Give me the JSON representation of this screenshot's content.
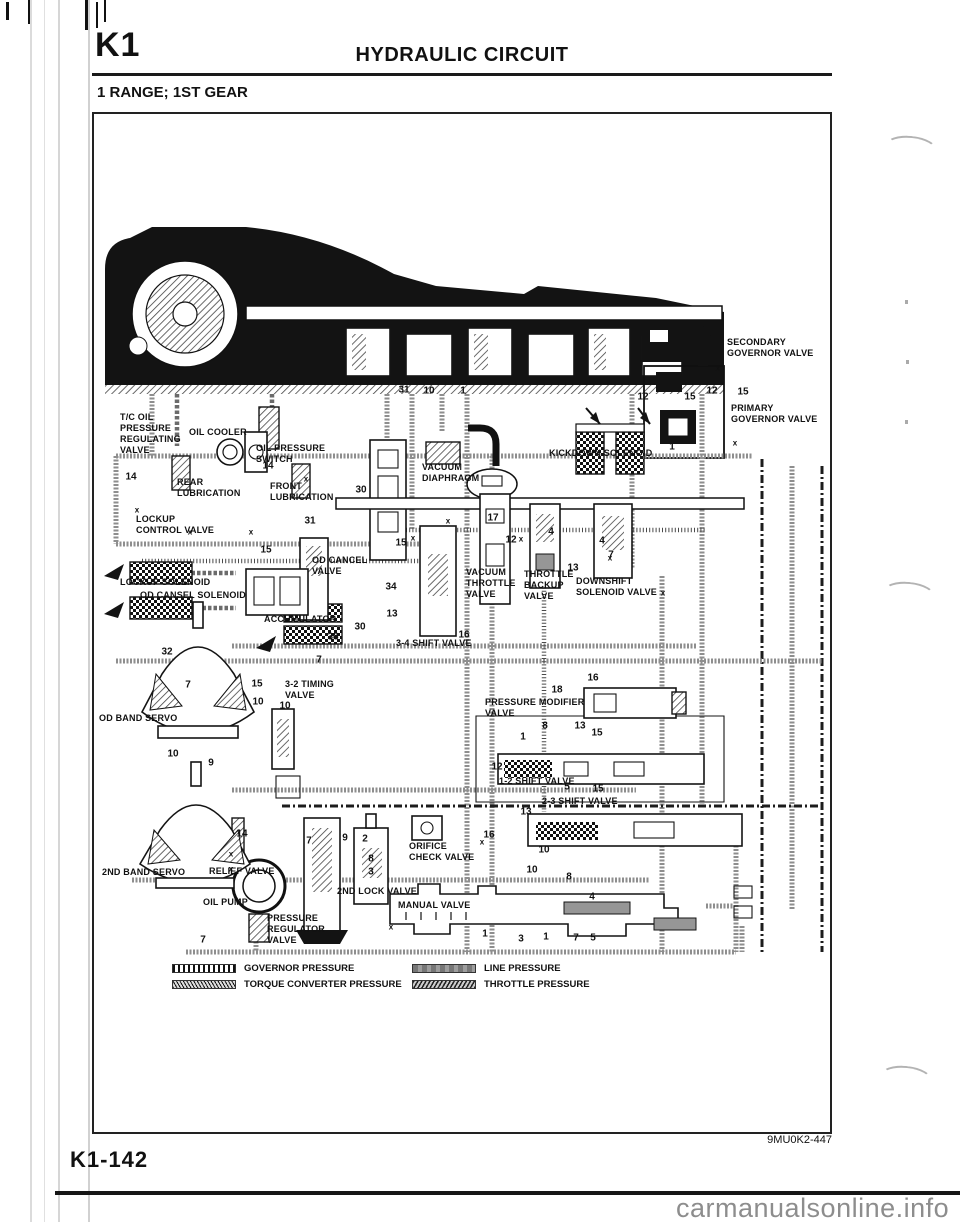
{
  "header": {
    "section_code": "K1",
    "title": "HYDRAULIC CIRCUIT"
  },
  "subtitle": "1 RANGE; 1ST GEAR",
  "diagram": {
    "figure_code": "9MU0K2-447",
    "labels": [
      {
        "name": "tc-oil-pressure-regulating-valve",
        "text": "T/C OIL\nPRESSURE\nREGULATING\nVALVE",
        "x": 120,
        "y": 412
      },
      {
        "name": "oil-cooler",
        "text": "OIL COOLER",
        "x": 189,
        "y": 427
      },
      {
        "name": "oil-pressure-switch",
        "text": "OIL PRESSURE\nSWITCH",
        "x": 256,
        "y": 443
      },
      {
        "name": "rear-lubrication",
        "text": "REAR\nLUBRICATION",
        "x": 177,
        "y": 477
      },
      {
        "name": "front-lubrication",
        "text": "FRONT\nLUBRICATION",
        "x": 270,
        "y": 481
      },
      {
        "name": "lockup-control-valve",
        "text": "LOCKUP\nCONTROL VALVE",
        "x": 136,
        "y": 514
      },
      {
        "name": "lockup-solenoid",
        "text": "LOCKUP SOLENOID",
        "x": 120,
        "y": 577
      },
      {
        "name": "od-cansel-solenoid",
        "text": "OD CANSEL SOLENOID",
        "x": 140,
        "y": 590
      },
      {
        "name": "od-cancel-valve",
        "text": "OD CANCEL\nVALVE",
        "x": 312,
        "y": 555
      },
      {
        "name": "accumulator",
        "text": "ACCUMULATOR",
        "x": 264,
        "y": 614
      },
      {
        "name": "3-4-shift-valve",
        "text": "3-4 SHIFT VALVE",
        "x": 396,
        "y": 638
      },
      {
        "name": "od-band-servo",
        "text": "OD BAND SERVO",
        "x": 99,
        "y": 713
      },
      {
        "name": "3-2-timing-valve",
        "text": "3-2 TIMING\nVALVE",
        "x": 285,
        "y": 679
      },
      {
        "name": "vacuum-diaphragm",
        "text": "VACUUM\nDIAPHRAGM",
        "x": 422,
        "y": 462
      },
      {
        "name": "kickdown-solenoid",
        "text": "KICKDOWN SOLENOID",
        "x": 549,
        "y": 448
      },
      {
        "name": "vacuum-throttle-valve",
        "text": "VACUUM\nTHROTTLE\nVALVE",
        "x": 466,
        "y": 567
      },
      {
        "name": "throttle-backup-valve",
        "text": "THROTTLE\nBACKUP\nVALVE",
        "x": 524,
        "y": 569
      },
      {
        "name": "downshift-solenoid-valve",
        "text": "DOWNSHIFT\nSOLENOID VALVE",
        "x": 576,
        "y": 576
      },
      {
        "name": "secondary-governor-valve",
        "text": "SECONDARY\nGOVERNOR VALVE",
        "x": 727,
        "y": 337
      },
      {
        "name": "primary-governor-valve",
        "text": "PRIMARY\nGOVERNOR VALVE",
        "x": 731,
        "y": 403
      },
      {
        "name": "pressure-modifier-valve",
        "text": "PRESSURE MODIFIER\nVALVE",
        "x": 485,
        "y": 697
      },
      {
        "name": "1-2-shift-valve",
        "text": "1-2 SHIFT VALVE",
        "x": 499,
        "y": 776
      },
      {
        "name": "2-3-shift-valve",
        "text": "2-3 SHIFT VALVE",
        "x": 542,
        "y": 796
      },
      {
        "name": "orifice-check-valve",
        "text": "ORIFICE\nCHECK VALVE",
        "x": 409,
        "y": 841
      },
      {
        "name": "2nd-lock-valve",
        "text": "2ND LOCK VALVE",
        "x": 337,
        "y": 886
      },
      {
        "name": "manual-valve",
        "text": "MANUAL VALVE",
        "x": 398,
        "y": 900
      },
      {
        "name": "2nd-band-servo",
        "text": "2ND BAND SERVO",
        "x": 102,
        "y": 867
      },
      {
        "name": "relief-valve",
        "text": "RELIEF VALVE",
        "x": 209,
        "y": 866
      },
      {
        "name": "oil-pump",
        "text": "OIL PUMP",
        "x": 203,
        "y": 897
      },
      {
        "name": "pressure-regulator-valve",
        "text": "PRESSURE\nREGULATOR\nVALVE",
        "x": 267,
        "y": 913
      }
    ],
    "callouts": [
      {
        "text": "31",
        "x": 404,
        "y": 390
      },
      {
        "text": "10",
        "x": 429,
        "y": 391
      },
      {
        "text": "1",
        "x": 463,
        "y": 391
      },
      {
        "text": "12",
        "x": 712,
        "y": 391
      },
      {
        "text": "15",
        "x": 743,
        "y": 392
      },
      {
        "text": "14",
        "x": 131,
        "y": 477
      },
      {
        "text": "14",
        "x": 268,
        "y": 466
      },
      {
        "text": "30",
        "x": 361,
        "y": 490
      },
      {
        "text": "31",
        "x": 310,
        "y": 521
      },
      {
        "text": "15",
        "x": 266,
        "y": 550
      },
      {
        "text": "15",
        "x": 401,
        "y": 543
      },
      {
        "text": "17",
        "x": 493,
        "y": 518
      },
      {
        "text": "12",
        "x": 511,
        "y": 540
      },
      {
        "text": "4",
        "x": 551,
        "y": 532
      },
      {
        "text": "4",
        "x": 602,
        "y": 541
      },
      {
        "text": "7",
        "x": 611,
        "y": 555
      },
      {
        "text": "13",
        "x": 573,
        "y": 568
      },
      {
        "text": "34",
        "x": 391,
        "y": 587
      },
      {
        "text": "13",
        "x": 392,
        "y": 614
      },
      {
        "text": "30",
        "x": 360,
        "y": 627
      },
      {
        "text": "38",
        "x": 333,
        "y": 637
      },
      {
        "text": "16",
        "x": 464,
        "y": 635
      },
      {
        "text": "7",
        "x": 319,
        "y": 660
      },
      {
        "text": "32",
        "x": 167,
        "y": 652
      },
      {
        "text": "7",
        "x": 188,
        "y": 685
      },
      {
        "text": "15",
        "x": 257,
        "y": 684
      },
      {
        "text": "10",
        "x": 258,
        "y": 702
      },
      {
        "text": "10",
        "x": 285,
        "y": 706
      },
      {
        "text": "10",
        "x": 173,
        "y": 754
      },
      {
        "text": "9",
        "x": 211,
        "y": 763
      },
      {
        "text": "12",
        "x": 643,
        "y": 397
      },
      {
        "text": "15",
        "x": 690,
        "y": 397
      },
      {
        "text": "1",
        "x": 672,
        "y": 447
      },
      {
        "text": "16",
        "x": 593,
        "y": 678
      },
      {
        "text": "18",
        "x": 557,
        "y": 690
      },
      {
        "text": "8",
        "x": 545,
        "y": 726
      },
      {
        "text": "13",
        "x": 580,
        "y": 726
      },
      {
        "text": "15",
        "x": 597,
        "y": 733
      },
      {
        "text": "1",
        "x": 523,
        "y": 737
      },
      {
        "text": "12",
        "x": 497,
        "y": 767
      },
      {
        "text": "5",
        "x": 567,
        "y": 787
      },
      {
        "text": "15",
        "x": 598,
        "y": 789
      },
      {
        "text": "13",
        "x": 526,
        "y": 812
      },
      {
        "text": "16",
        "x": 489,
        "y": 835
      },
      {
        "text": "10",
        "x": 544,
        "y": 850
      },
      {
        "text": "10",
        "x": 532,
        "y": 870
      },
      {
        "text": "8",
        "x": 569,
        "y": 877
      },
      {
        "text": "4",
        "x": 592,
        "y": 897
      },
      {
        "text": "1",
        "x": 485,
        "y": 934
      },
      {
        "text": "3",
        "x": 521,
        "y": 939
      },
      {
        "text": "1",
        "x": 546,
        "y": 937
      },
      {
        "text": "7",
        "x": 576,
        "y": 938
      },
      {
        "text": "5",
        "x": 593,
        "y": 938
      },
      {
        "text": "14",
        "x": 242,
        "y": 834
      },
      {
        "text": "7",
        "x": 309,
        "y": 841
      },
      {
        "text": "9",
        "x": 345,
        "y": 838
      },
      {
        "text": "2",
        "x": 365,
        "y": 839
      },
      {
        "text": "8",
        "x": 371,
        "y": 859
      },
      {
        "text": "3",
        "x": 371,
        "y": 872
      },
      {
        "text": "7",
        "x": 203,
        "y": 940
      },
      {
        "text": "x",
        "small": true,
        "x": 137,
        "y": 510
      },
      {
        "text": "x",
        "small": true,
        "x": 190,
        "y": 532
      },
      {
        "text": "x",
        "small": true,
        "x": 251,
        "y": 532
      },
      {
        "text": "x",
        "small": true,
        "x": 306,
        "y": 479
      },
      {
        "text": "x",
        "small": true,
        "x": 413,
        "y": 538
      },
      {
        "text": "x",
        "small": true,
        "x": 448,
        "y": 521
      },
      {
        "text": "x",
        "small": true,
        "x": 521,
        "y": 539
      },
      {
        "text": "x",
        "small": true,
        "x": 610,
        "y": 558
      },
      {
        "text": "x",
        "small": true,
        "x": 663,
        "y": 593
      },
      {
        "text": "x",
        "small": true,
        "x": 482,
        "y": 842
      },
      {
        "text": "x",
        "small": true,
        "x": 391,
        "y": 927
      },
      {
        "text": "x",
        "small": true,
        "x": 231,
        "y": 854
      },
      {
        "text": "x",
        "small": true,
        "x": 231,
        "y": 869
      },
      {
        "text": "x",
        "small": true,
        "x": 718,
        "y": 368
      },
      {
        "text": "x",
        "small": true,
        "x": 735,
        "y": 443
      }
    ],
    "legend": [
      {
        "label": "GOVERNOR PRESSURE",
        "pattern": "governor"
      },
      {
        "label": "LINE PRESSURE",
        "pattern": "line"
      },
      {
        "label": "TORQUE CONVERTER PRESSURE",
        "pattern": "torque"
      },
      {
        "label": "THROTTLE PRESSURE",
        "pattern": "throttle"
      }
    ]
  },
  "footer": {
    "page_number": "K1-142"
  },
  "watermark": "carmanualsonline.info",
  "colors": {
    "ink": "#111111",
    "pipe_gray": "#8e8e8e",
    "watermark_gray": "#8d8d8d"
  }
}
